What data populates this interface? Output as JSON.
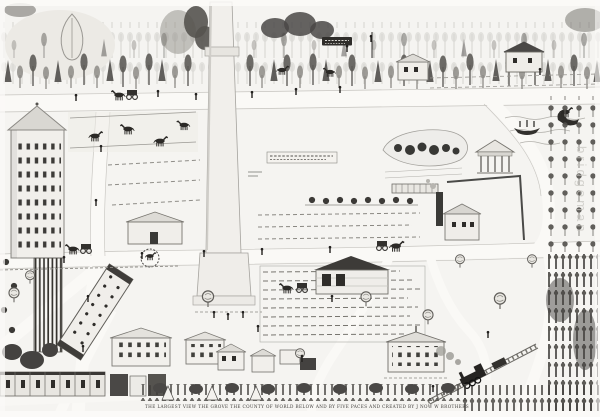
{
  "artwork": {
    "kind": "scanned pen-and-ink folk-art bird's-eye view map of a town with a central obelisk monument",
    "palette": {
      "paper": "#f5f4f1",
      "ink_dark": "#2b2926",
      "ink_mid": "#6b6964",
      "ink_light": "#b3b1ac",
      "watermark": "#c6c4bf"
    },
    "caption": {
      "text": "THE LARGEST VIEW THE GROVE THE COUNTY OF WORLD BELOW AND BY FIVE PACES AND CREATED BY J NOW W BROTHERS",
      "legibility": "hand-lettered micro caption, illegible at source resolution"
    },
    "watermark": {
      "text": "bridgeman",
      "orientation": "vertical, faint, right edge"
    },
    "legend": {
      "monument": "tall white obelisk monument at center",
      "top_forest": "band of tall trees across the top",
      "left_tower": "multi-storey tower with pyramidal roof and window grid",
      "pasture": "fenced pasture with horses, middle left",
      "pond": "pond with dark shrubs, middle right",
      "temple": "small columned pavilion",
      "factory": "building with smoking chimney",
      "orchard": "orchard rows along right side",
      "fields": "striped crop rows below the monument",
      "train": "locomotive on diagonal track, lower right",
      "village": "rows of houses along the bottom",
      "boats": "rowboat and swan on water, upper right"
    }
  }
}
